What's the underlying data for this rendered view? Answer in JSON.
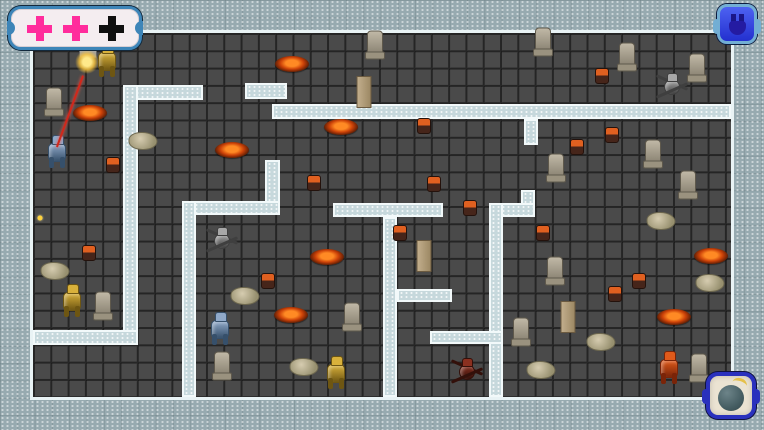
{
  "palette": {
    "border_fill": "#97aab0",
    "floor": "#4a4a4a",
    "wall_fill": "#c6d8dc",
    "wall_edge": "#f2f9fa",
    "frame_edge": "#e9f3f5",
    "laser": "#d0281c",
    "hud_pink": "#ff2c9c",
    "hud_black": "#101010",
    "button_blue": "#2330cf",
    "bomb_body": "#465e63",
    "bomb_fuse": "#e5c04a"
  },
  "hud": {
    "health_panel": {
      "x": 8,
      "y": 6,
      "w": 128,
      "h": 38,
      "crosses": [
        "#ff2c9c",
        "#ff2c9c",
        "#101010"
      ]
    },
    "pause_button": {
      "x": 717,
      "y": 4,
      "w": 40,
      "h": 40,
      "icon": "pause-icon"
    },
    "bomb_button": {
      "x": 706,
      "y": 372,
      "w": 50,
      "h": 47,
      "icon": "bomb-icon"
    }
  },
  "map": {
    "tile_size": 17.3,
    "border_thickness": 33,
    "playfield": {
      "x": 33,
      "y": 33,
      "w": 698,
      "h": 364
    },
    "walls": [
      {
        "x": 123,
        "y": 85,
        "w": 80,
        "h": 15
      },
      {
        "x": 123,
        "y": 85,
        "w": 15,
        "h": 260
      },
      {
        "x": 33,
        "y": 330,
        "w": 105,
        "h": 15
      },
      {
        "x": 245,
        "y": 83,
        "w": 42,
        "h": 16
      },
      {
        "x": 272,
        "y": 104,
        "w": 459,
        "h": 15
      },
      {
        "x": 524,
        "y": 119,
        "w": 14,
        "h": 26
      },
      {
        "x": 265,
        "y": 160,
        "w": 15,
        "h": 55
      },
      {
        "x": 182,
        "y": 201,
        "w": 98,
        "h": 14
      },
      {
        "x": 182,
        "y": 201,
        "w": 14,
        "h": 196
      },
      {
        "x": 333,
        "y": 203,
        "w": 110,
        "h": 14
      },
      {
        "x": 383,
        "y": 217,
        "w": 14,
        "h": 180
      },
      {
        "x": 397,
        "y": 289,
        "w": 55,
        "h": 13
      },
      {
        "x": 521,
        "y": 190,
        "w": 14,
        "h": 27
      },
      {
        "x": 489,
        "y": 203,
        "w": 46,
        "h": 14
      },
      {
        "x": 489,
        "y": 203,
        "w": 14,
        "h": 194
      },
      {
        "x": 430,
        "y": 331,
        "w": 73,
        "h": 13
      }
    ],
    "items": [
      {
        "type": "lava",
        "x": 292,
        "y": 64
      },
      {
        "type": "lava",
        "x": 90,
        "y": 113
      },
      {
        "type": "lava",
        "x": 232,
        "y": 150
      },
      {
        "type": "lava",
        "x": 341,
        "y": 127
      },
      {
        "type": "lava",
        "x": 327,
        "y": 257
      },
      {
        "type": "lava",
        "x": 291,
        "y": 315
      },
      {
        "type": "lava",
        "x": 711,
        "y": 256
      },
      {
        "type": "lava",
        "x": 674,
        "y": 317
      },
      {
        "type": "ember",
        "x": 602,
        "y": 76
      },
      {
        "type": "ember",
        "x": 424,
        "y": 126
      },
      {
        "type": "ember",
        "x": 577,
        "y": 147
      },
      {
        "type": "ember",
        "x": 612,
        "y": 135
      },
      {
        "type": "ember",
        "x": 434,
        "y": 184
      },
      {
        "type": "ember",
        "x": 470,
        "y": 208
      },
      {
        "type": "ember",
        "x": 314,
        "y": 183
      },
      {
        "type": "ember",
        "x": 400,
        "y": 233
      },
      {
        "type": "ember",
        "x": 543,
        "y": 233
      },
      {
        "type": "ember",
        "x": 89,
        "y": 253
      },
      {
        "type": "ember",
        "x": 113,
        "y": 165
      },
      {
        "type": "ember",
        "x": 639,
        "y": 281
      },
      {
        "type": "ember",
        "x": 615,
        "y": 294
      },
      {
        "type": "ember",
        "x": 268,
        "y": 281
      },
      {
        "type": "rock",
        "x": 143,
        "y": 141
      },
      {
        "type": "rock",
        "x": 55,
        "y": 271
      },
      {
        "type": "rock",
        "x": 245,
        "y": 296
      },
      {
        "type": "rock",
        "x": 304,
        "y": 367
      },
      {
        "type": "rock",
        "x": 661,
        "y": 221
      },
      {
        "type": "rock",
        "x": 710,
        "y": 283
      },
      {
        "type": "rock",
        "x": 601,
        "y": 342
      },
      {
        "type": "rock",
        "x": 541,
        "y": 370
      },
      {
        "type": "statue",
        "x": 54,
        "y": 101
      },
      {
        "type": "statue",
        "x": 103,
        "y": 305
      },
      {
        "type": "statue",
        "x": 222,
        "y": 365
      },
      {
        "type": "statue",
        "x": 352,
        "y": 316
      },
      {
        "type": "statue",
        "x": 375,
        "y": 44
      },
      {
        "type": "statue",
        "x": 543,
        "y": 41
      },
      {
        "type": "statue",
        "x": 627,
        "y": 56
      },
      {
        "type": "statue",
        "x": 697,
        "y": 67
      },
      {
        "type": "statue",
        "x": 653,
        "y": 153
      },
      {
        "type": "statue",
        "x": 688,
        "y": 184
      },
      {
        "type": "statue",
        "x": 556,
        "y": 167
      },
      {
        "type": "statue",
        "x": 699,
        "y": 367
      },
      {
        "type": "statue",
        "x": 555,
        "y": 270
      },
      {
        "type": "statue",
        "x": 521,
        "y": 331
      },
      {
        "type": "pillar",
        "x": 364,
        "y": 92
      },
      {
        "type": "pillar",
        "x": 424,
        "y": 256
      },
      {
        "type": "pillar",
        "x": 568,
        "y": 317
      },
      {
        "type": "block",
        "x": 88,
        "y": 49
      }
    ],
    "robots": [
      {
        "type": "gold-mech",
        "x": 107,
        "y": 60
      },
      {
        "type": "blue-mech",
        "x": 57,
        "y": 151
      },
      {
        "type": "gray-spider",
        "x": 222,
        "y": 240
      },
      {
        "type": "gold-mech",
        "x": 72,
        "y": 300
      },
      {
        "type": "blue-mech",
        "x": 220,
        "y": 328
      },
      {
        "type": "gold-mech",
        "x": 336,
        "y": 372
      },
      {
        "type": "red-spider",
        "x": 467,
        "y": 371
      },
      {
        "type": "flame-mech",
        "x": 669,
        "y": 367
      },
      {
        "type": "gray-spider",
        "x": 672,
        "y": 86
      }
    ],
    "robot_styles": {
      "gold-mech": {
        "c1": "#d9b13b",
        "c2": "#6e5612",
        "kind": "mech"
      },
      "blue-mech": {
        "c1": "#90a9c9",
        "c2": "#36506b",
        "kind": "mech"
      },
      "gray-spider": {
        "c1": "#a8a8a8",
        "c2": "#3f3f3f",
        "kind": "spider"
      },
      "red-spider": {
        "c1": "#8a3020",
        "c2": "#33100a",
        "kind": "spider"
      },
      "flame-mech": {
        "c1": "#e05a1a",
        "c2": "#7a2408",
        "kind": "mech"
      }
    },
    "effects": {
      "laser": {
        "x1": 84,
        "y1": 76,
        "x2": 58,
        "y2": 147,
        "color": "#d0281c"
      },
      "muzzle_flash": {
        "x": 87,
        "y": 62
      },
      "spark": {
        "x": 40,
        "y": 218
      }
    }
  }
}
